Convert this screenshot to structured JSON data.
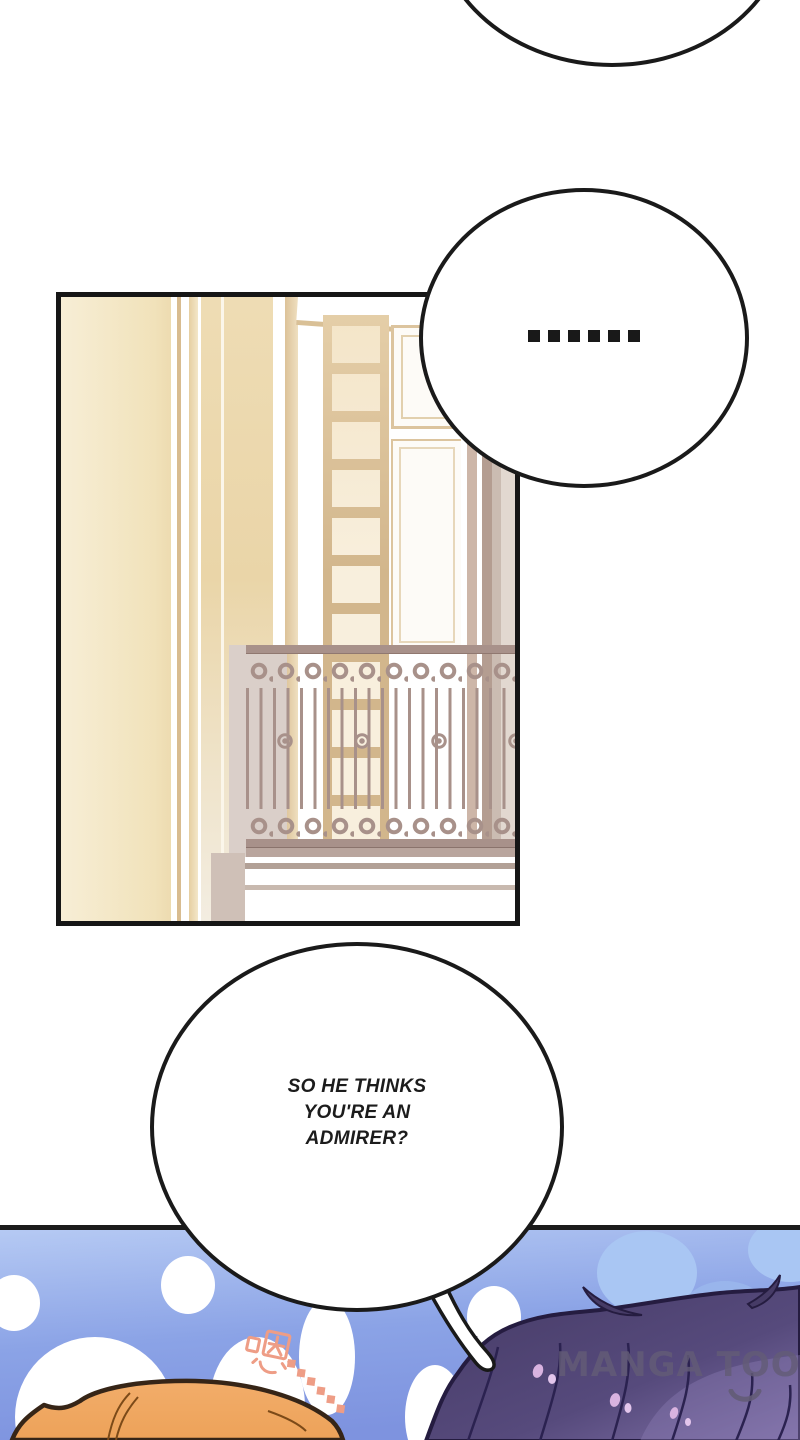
{
  "page": {
    "type": "webtoon-comic-page"
  },
  "bubbles": {
    "top": {
      "text": ""
    },
    "middle": {
      "text": "……"
    },
    "question": {
      "text": "SO HE THINKS\nYOU'RE AN\nADMIRER?"
    }
  },
  "bottom_scene": {
    "onomatopoeia": "嗯……",
    "watermark": "MANGA TOON"
  },
  "colors": {
    "outline_black": "#1a1a1a",
    "sky_top": "#b7cbf4",
    "sky_bottom": "#7e93df",
    "cloud_blue": "#a9c6f3",
    "petal_white": "#ffffff",
    "hair_dark_purple": "#463b66",
    "hair_light_purple": "#8071a8",
    "hair_outline": "#251c40",
    "head_orange": "#f0a95f",
    "head_outline": "#362517",
    "wall_cream": "#f4e8c7",
    "wall_beige": "#ecd9ac",
    "frame_tan": "#d2b68c",
    "railing_taupe": "#a8918a",
    "onomatopoeia_salmon": "#ee9d86",
    "watermark_gray": "#635c76"
  }
}
